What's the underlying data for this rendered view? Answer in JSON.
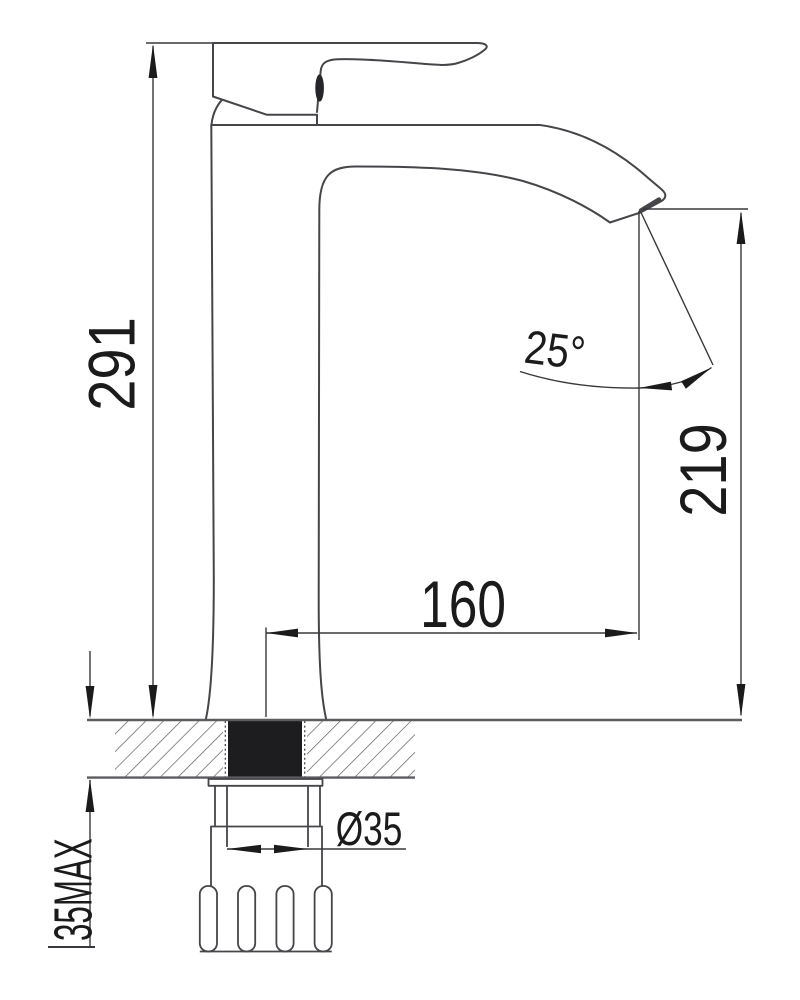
{
  "drawing": {
    "dimensions": {
      "overall_height": "291",
      "outlet_height": "219",
      "spout_reach": "160",
      "outlet_angle": "25°",
      "hole_diameter": "Ø35",
      "max_deck_thickness": "35MAX"
    },
    "colors": {
      "background": "#ffffff",
      "outline": "#46464a",
      "counter": "#5c5c60",
      "dimension_lines": "#38383c",
      "text": "#1b1b1b",
      "solid_section": "#1d1d1f"
    }
  }
}
